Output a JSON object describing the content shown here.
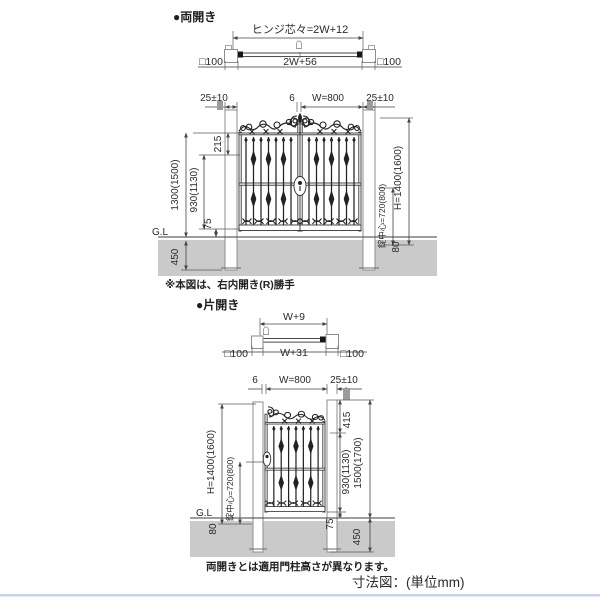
{
  "double": {
    "section_label": "●両開き",
    "plan": {
      "hinge_dim": "ヒンジ芯々=2W+12",
      "width_dim": "2W+56",
      "post_left": "□100",
      "post_right": "□100"
    },
    "elevation": {
      "offset_left": "25±10",
      "gap": "6",
      "leaf_width": "W=800",
      "offset_right": "25±10",
      "top_offset": "215",
      "post_height": "1300(1500)",
      "body_height": "930(1130)",
      "bottom_clearance": "75",
      "ground_label": "G.L",
      "embed_depth": "450",
      "gate_height": "H=1400(1600)",
      "lock_center": "錠中心=720(800)",
      "below_gl": "80"
    },
    "note": "※本図は、右内開き(R)勝手"
  },
  "single": {
    "section_label": "●片開き",
    "plan": {
      "hinge_dim": "W+9",
      "width_dim": "W+31",
      "post_left": "□100",
      "post_right": "□100"
    },
    "elevation": {
      "gap": "6",
      "leaf_width": "W=800",
      "offset_right": "25±10",
      "gate_height": "H=1400(1600)",
      "lock_center": "錠中心=720(800)",
      "ground_label": "G.L",
      "below_gl": "80",
      "top_offset": "415",
      "body_height": "930(1130)",
      "post_height": "1500(1700)",
      "bottom_clearance": "75",
      "embed_depth": "450"
    }
  },
  "footer": {
    "note": "両開きとは適用門柱高さが異なります。",
    "unit": "寸法図：(単位mm)"
  },
  "colors": {
    "ground": "#cacaca",
    "line": "#454545",
    "accent_rule": "#c7d0e8"
  }
}
